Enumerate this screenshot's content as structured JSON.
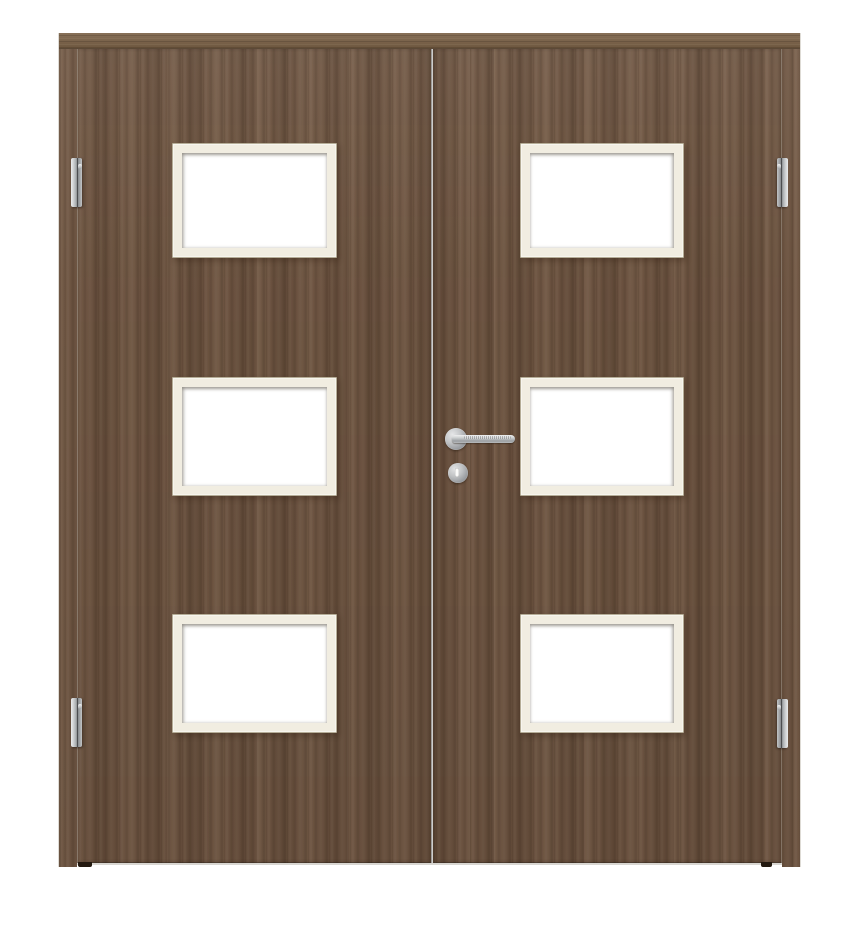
{
  "scene": {
    "subject": "Double interior door, walnut wood finish",
    "details": "Two wooden door leaves inside a matching walnut frame; each leaf has three rectangular white glass cutouts with pale cream glazing beads; stainless steel lever handle on round rose with keyhole escutcheon below on the right leaf; two barrel hinges visible on the left jamb and two on the right jamb; white studio background",
    "counts": {
      "door_leaves": 2,
      "glass_panels": 6,
      "visible_hinges": 4,
      "handles": 1,
      "keyholes": 1
    }
  },
  "icons": {
    "handle": "lever-handle-icon",
    "keyhole": "keyhole-icon",
    "hinge": "hinge-icon"
  },
  "colors": {
    "background": "#ffffff",
    "wood_base": "#6c5340",
    "wood_light": "#7f654b",
    "wood_dark": "#4e3a2a",
    "head_rail": "#7a6146",
    "glazing_bead": "#f1ede1",
    "bead_edge": "#b5ad97",
    "glass": "#ffffff",
    "steel_light": "#eceded",
    "steel_mid": "#aaadaf",
    "steel_dark": "#7d8083",
    "seam_dark": "#231910",
    "floor_line": "#d8d6d1"
  }
}
